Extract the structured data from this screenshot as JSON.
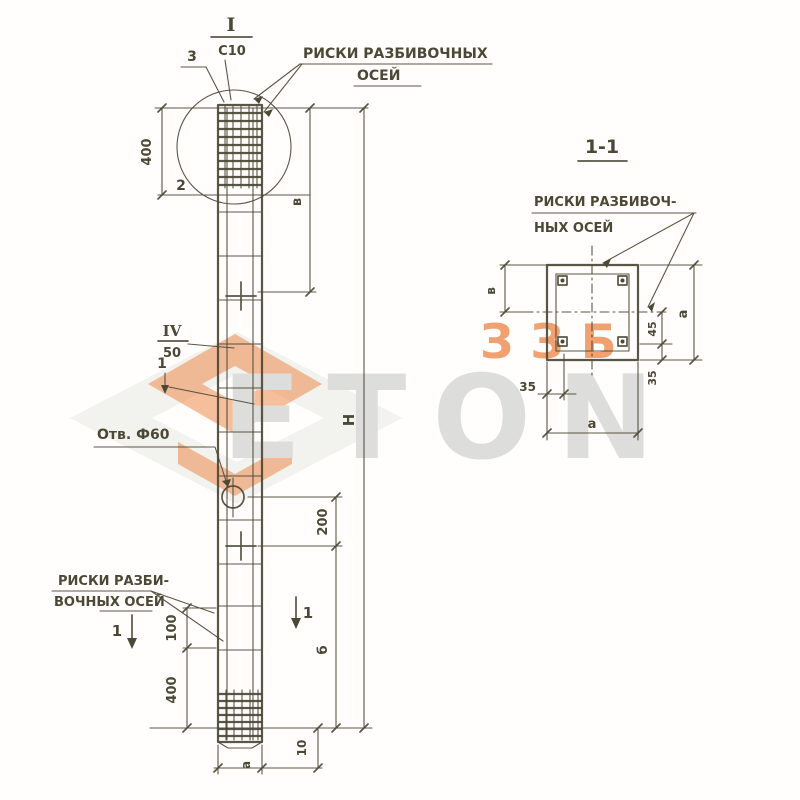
{
  "watermark": {
    "orange_text": "ЗЗБ",
    "gray_text": "ETON",
    "orange_color": "#ed8a4c",
    "gray_color": "#dddddb"
  },
  "elevation": {
    "marker_top": {
      "roman": "I",
      "value": "С10"
    },
    "marker_mid": {
      "roman": "IV",
      "value": "50"
    },
    "callout_1": "1",
    "callout_2": "2",
    "callout_3": "3",
    "axis_label_top": {
      "line1": "РИСКИ РАЗБИВОЧНЫХ",
      "line2": "ОСЕЙ"
    },
    "axis_label_bottom": {
      "line1": "РИСКИ РАЗБИ-",
      "line2": "ВОЧНЫХ ОСЕЙ"
    },
    "hole_label": "Отв. Ф60",
    "section_cut_left": "1",
    "section_cut_right": "1",
    "dim_400_top": "400",
    "dim_v": "в",
    "dim_200": "200",
    "dim_b": "б",
    "dim_H": "Н",
    "dim_100": "100",
    "dim_400_bottom": "400",
    "dim_a": "а",
    "dim_10": "10"
  },
  "section": {
    "title": "1-1",
    "axis_label": {
      "line1": "РИСКИ РАЗБИВОЧ-",
      "line2": "НЫХ ОСЕЙ"
    },
    "dim_v": "в",
    "dim_35_bottom": "35",
    "dim_a_bottom": "а",
    "dim_45_right": "45",
    "dim_35_right": "35",
    "dim_a_right": "а"
  }
}
